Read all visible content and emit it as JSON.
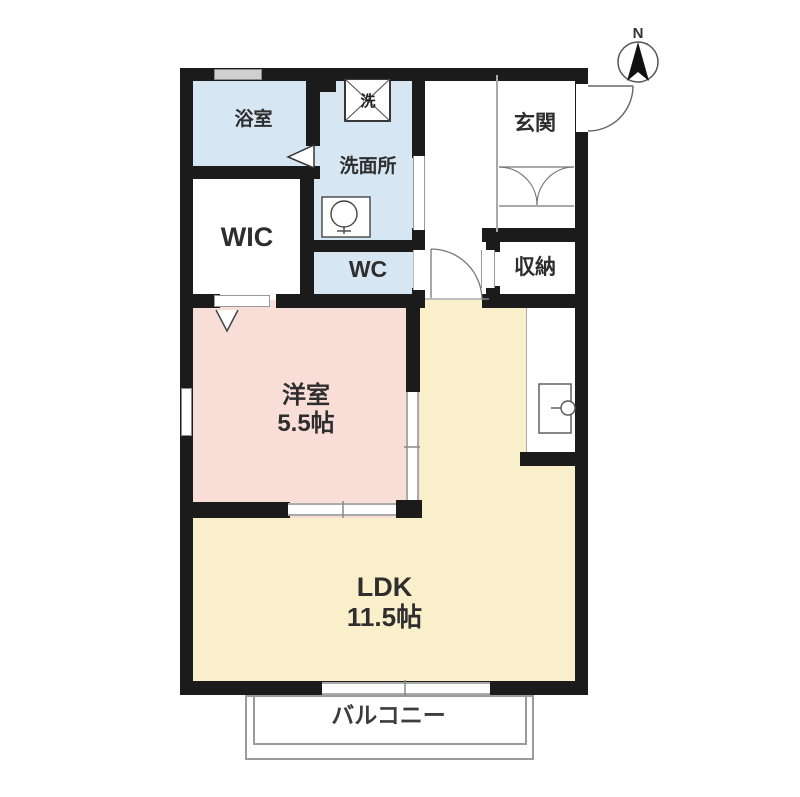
{
  "compass": {
    "north_label": "N"
  },
  "rooms": {
    "bath": {
      "label": "浴室"
    },
    "washroom": {
      "label": "洗面所"
    },
    "wic": {
      "label": "WIC"
    },
    "wc": {
      "label": "WC"
    },
    "entrance": {
      "label": "玄関"
    },
    "storage": {
      "label": "収納"
    },
    "western_room": {
      "label": "洋室",
      "size": "5.5帖"
    },
    "ldk": {
      "label": "LDK",
      "size": "11.5帖"
    },
    "balcony": {
      "label": "バルコニー"
    }
  },
  "fixtures": {
    "washing_machine": "洗"
  },
  "colors": {
    "wet_area": "#d6e6f2",
    "western_room": "#f9ded8",
    "ldk": "#f9efca",
    "wall": "#1b1b1b"
  }
}
